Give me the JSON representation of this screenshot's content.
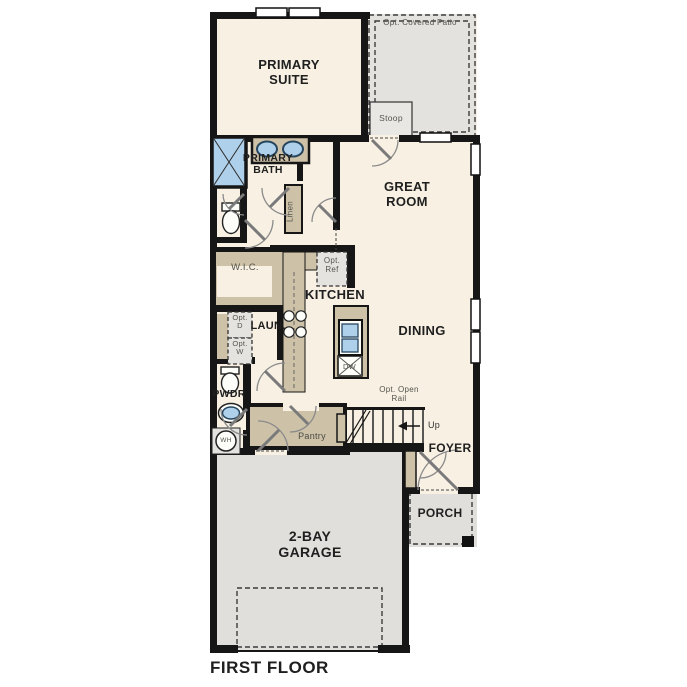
{
  "floor_plan": {
    "title": "FIRST FLOOR",
    "rooms": {
      "primary_suite": "PRIMARY SUITE",
      "primary_bath": "PRIMARY BATH",
      "wic": "W.I.C.",
      "linen": "Linen",
      "great_room": "GREAT ROOM",
      "kitchen": "KITCHEN",
      "dining": "DINING",
      "laundry": "LAUN.",
      "powder": "PWDR",
      "pantry": "Pantry",
      "foyer": "FOYER",
      "porch": "PORCH",
      "garage": "2-BAY GARAGE",
      "stoop": "Stoop",
      "patio": "Opt. Covered Patio"
    },
    "annotations": {
      "opt_ref": "Opt. Ref",
      "opt_dryer": "Opt. D",
      "opt_washer": "Opt. W",
      "opt_open_rail": "Opt. Open Rail",
      "up": "Up",
      "water_heater": "WH",
      "dishwasher": "DW"
    },
    "colors": {
      "wall": "#161616",
      "room_fill": "#f7f0e3",
      "cabinet_tan": "#cdc1a8",
      "patio_gray": "#e3e2de",
      "garage_gray": "#e0dfdb",
      "fixture_blue": "#afd0ea",
      "label_dark": "#1f1f1f",
      "label_gray": "#55554d"
    }
  }
}
